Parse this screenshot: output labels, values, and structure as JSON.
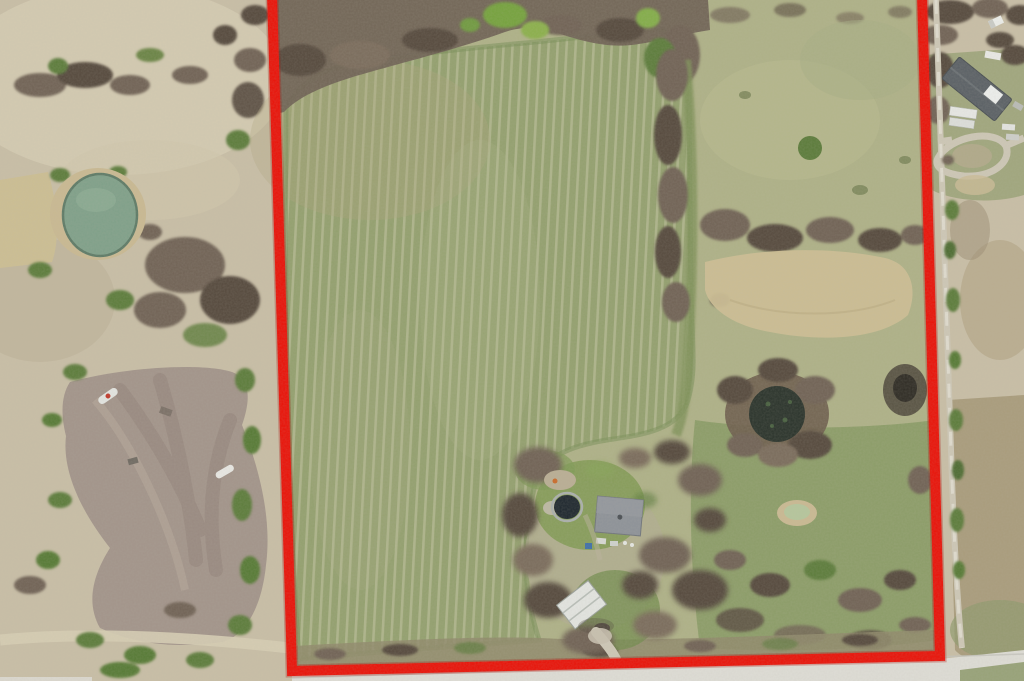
{
  "scene": {
    "type": "aerial-drone-photograph",
    "subject": "Rural acreage listing photo: parcel outlined in red containing a large mowed hay field, farmhouse with round pool, white shed, dark stock pond, dry pasture; neighboring dirt clearing with boats to the west, neighbor house with loop driveway to the northeast, gravel drive along east line and paved road along the bottom",
    "palette": {
      "boundary_red": "#e91208",
      "boundary_red_shadow": "#a80d05",
      "field_green": "#93a06e",
      "field_stripe": "#c6c7a5",
      "field_edge": "#7a8f5a",
      "grass_south": "#8c9d68",
      "pasture": "#aeb187",
      "dry_field": "#ccbe93",
      "lawn": "#7d984f",
      "scrub": "#c8bea6",
      "scrub_light": "#d6cdb4",
      "dirt": "#a2948a",
      "dirt_dark": "#8d7f76",
      "tree_brown": "#6f6254",
      "tree_dark": "#55483d",
      "tree_green": "#5b7b3a",
      "tree_bright": "#74a23c",
      "pond_water": "#7fa089",
      "pond_bank": "#c9b992",
      "dark_pond": "#2a332b",
      "small_pond": "#b5c69c",
      "road_concrete": "#deddd6",
      "road_gravel": "#cdc7b6",
      "roof_main": "#8d9298",
      "roof_dark": "#5a6065",
      "white_structure": "#e3e5e1",
      "boat_red": "#c0392b"
    },
    "features": {
      "boundary": "red property-boundary outline (open at top edge)",
      "main_field": "large striped mowed field inside parcel",
      "pond_west": "green farm pond outside parcel to the west",
      "pond_east": "dark round stock pond inside parcel",
      "pond_small": "small pale pond in south pasture",
      "homestead": "farmhouse with gray roof, round pool, white shed, driveway",
      "neighbor_house": "neighboring house with dark roof, trailers and loop driveway",
      "dirt_clearing": "cleared dirt lot with boats and debris to the west",
      "road_bottom": "light paved road along bottom edge",
      "road_east": "gravel drive running along the east boundary"
    }
  }
}
